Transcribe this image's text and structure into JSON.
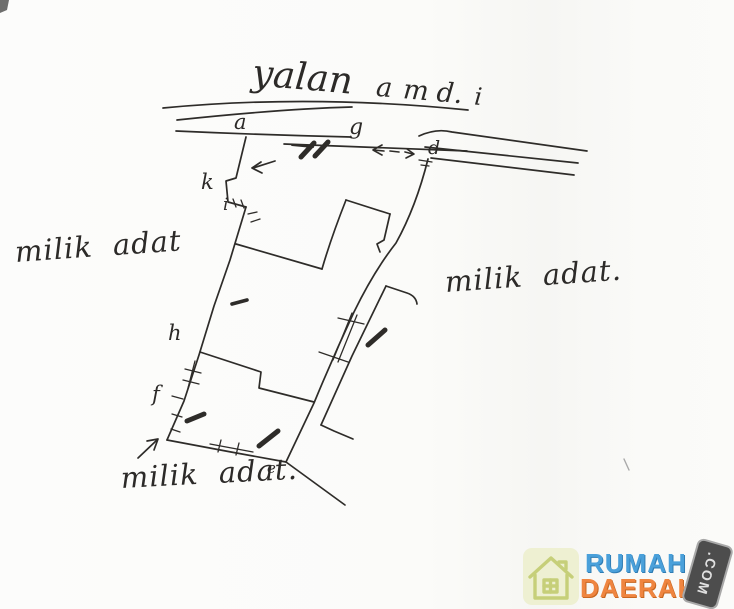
{
  "page": {
    "background": "#fbfbf9",
    "ink_color": "#2e2c29",
    "description": "hand-drawn land parcel sketch"
  },
  "street_label": {
    "word1": "yalan",
    "word2": "a",
    "word3": "m",
    "word4": "d.",
    "word5": "i"
  },
  "region_labels": {
    "left": "milik adat",
    "right": "milik adat.",
    "bottom": "milik adat."
  },
  "point_labels": {
    "a": "a",
    "g": "g",
    "d": "d",
    "k": "k",
    "i": "i",
    "h": "h",
    "f": "f",
    "e": "e"
  },
  "watermark": {
    "brand_line1": "RUMAH",
    "brand_line2": "DAERAH",
    "brand_suffix": ".COM",
    "colors": {
      "line1_blue": "#4aa0da",
      "line2_orange": "#ef8540",
      "tag_bg": "#4d4d4d",
      "tag_text": "#e0e0e0",
      "tile_bg": "#eef0d2",
      "house_outline": "#c6cf79"
    }
  }
}
